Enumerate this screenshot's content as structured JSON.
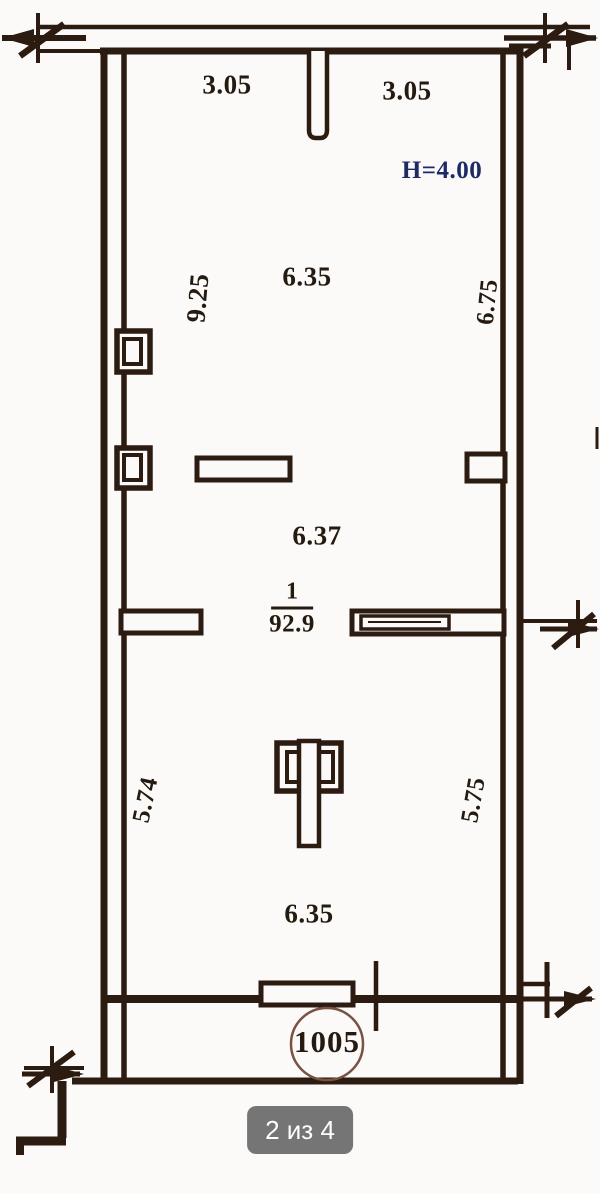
{
  "colors": {
    "ink": "#2b1b10",
    "ink_text": "#241a10",
    "paper": "#fbfaf8",
    "navy": "#1c2a66",
    "badge_bg": "#757575",
    "badge_text": "#ffffff",
    "circle_stroke": "#7a5243"
  },
  "viewer": {
    "pager": "2 из 4"
  },
  "floorplan": {
    "ceiling_height": "H=4.00",
    "unit_circle": "1005",
    "room_index": "1",
    "room_area": "92.9",
    "dimensions": {
      "top_left_width": "3.05",
      "top_right_width": "3.05",
      "upper_height_left": "9.25",
      "upper_width": "6.35",
      "upper_height_right": "6.75",
      "middle_width": "6.37",
      "lower_height_left": "5.74",
      "lower_height_right": "5.75",
      "lower_width": "6.35"
    }
  }
}
